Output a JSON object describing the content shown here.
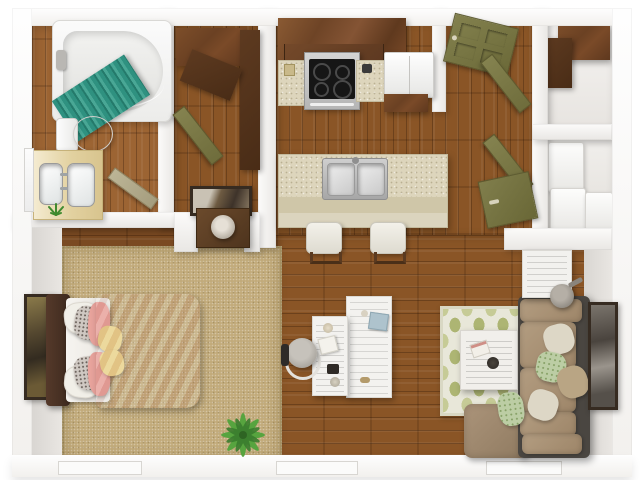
{
  "scene": {
    "type": "3d-floorplan-render",
    "title": "One-bedroom apartment 3D floor plan, top-down view",
    "canvas": {
      "width": 640,
      "height": 480
    }
  },
  "palette": {
    "bg": "#ffffff",
    "wall_hi": "#fcfbfa",
    "wall_lo": "#e9e7e4",
    "wall_face": "#d9d6d2",
    "wood_light": "#9c6433",
    "wood_mid": "#8a5526",
    "wood_dark": "#7a4a22",
    "carpet": "#c2ab7b",
    "counter": "#ddd5bc",
    "counter_front": "#cfc6a8",
    "cabinet": "#724526",
    "cabinet_dark": "#583620",
    "door_olive": "#7d7b4a",
    "bathroom_door": "#b3ab8c",
    "tub_white": "#f7f7f7",
    "fixture_white": "#f4f3f1",
    "curtain_teal": "#2f9180",
    "curtain_teal_dark": "#247a6b",
    "bed_pink": "#e59a92",
    "bed_pink_dark": "#d4837c",
    "pillow_yellow": "#e9d38d",
    "pillow_gray": "#cfc8c2",
    "sofa_frame": "#4a4641",
    "sofa_tan": "#a99377",
    "pillow_cream": "#ddd7c6",
    "pillow_green": "#bccda4",
    "ottoman": "#a18a6e",
    "rug_cream": "#e8e7d9",
    "rug_green": "#adb573",
    "rug_green_light": "#c6cb96",
    "steel": "#b9b9b9",
    "cooktop": "#161616",
    "plant_green": "#4f9d3f",
    "plant_green_dark": "#3a7d2e",
    "art_frame": "#362b21"
  },
  "rooms": [
    {
      "name": "bathroom",
      "furniture": [
        "bathtub",
        "shower-curtain",
        "shower-head",
        "toilet",
        "double-sink-vanity",
        "vanity-plant",
        "mirror",
        "bathroom-door"
      ]
    },
    {
      "name": "walk-in-closet",
      "furniture": [
        "wardrobe",
        "wardrobe-door-panel",
        "closet-door"
      ]
    },
    {
      "name": "hall-nook",
      "furniture": [
        "wall-art",
        "chest",
        "table-lamp"
      ]
    },
    {
      "name": "kitchen",
      "furniture": [
        "upper-cabinets",
        "range-stove",
        "countertop-left",
        "countertop-right",
        "refrigerator",
        "island-counter",
        "double-basin-sink",
        "bar-stool-left",
        "bar-stool-right"
      ]
    },
    {
      "name": "entry-hall",
      "furniture": [
        "front-door",
        "open-closet-door-upper",
        "open-closet-door-lower",
        "open-door-panel"
      ]
    },
    {
      "name": "storage-closets",
      "furniture": [
        "shelf-unit",
        "washer",
        "dryer"
      ]
    },
    {
      "name": "bedroom",
      "furniture": [
        "headboard",
        "mattress",
        "pillows",
        "comforter",
        "wall-art",
        "area-carpet",
        "floor-plant"
      ]
    },
    {
      "name": "living-room",
      "furniture": [
        "desk",
        "desk-return",
        "office-chair",
        "area-rug",
        "coffee-table",
        "ottoman",
        "sectional-sofa",
        "throw-pillows",
        "side-table",
        "lamp",
        "wall-art"
      ]
    }
  ],
  "windows": {
    "count": 3,
    "location": "bottom exterior wall"
  }
}
